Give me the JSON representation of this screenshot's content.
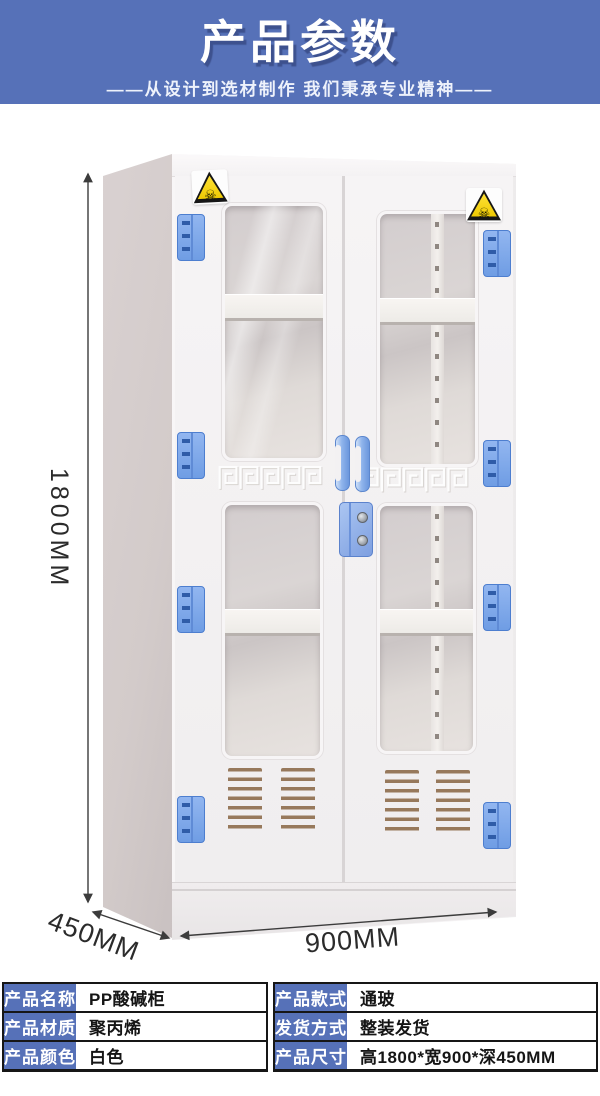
{
  "banner": {
    "title": "产品参数",
    "subtitle": "——从设计到选材制作 我们秉承专业精神——"
  },
  "figure": {
    "dimensions": {
      "height": "1800MM",
      "width": "900MM",
      "depth": "450MM"
    },
    "warning_symbol": "☠"
  },
  "colors": {
    "banner_bg": "#5671b8",
    "table_header_bg": "#5671b8",
    "hinge_blue": "#7fa8e8",
    "sticker_yellow": "#f2d200",
    "cabinet_white": "#f4f2f3"
  },
  "spec_table": {
    "left_rows": [
      {
        "label": "产品名称",
        "value": "PP酸碱柜"
      },
      {
        "label": "产品材质",
        "value": "聚丙烯"
      },
      {
        "label": "产品颜色",
        "value": "白色"
      }
    ],
    "right_rows": [
      {
        "label": "产品款式",
        "value": "通玻"
      },
      {
        "label": "发货方式",
        "value": "整装发货"
      },
      {
        "label": "产品尺寸",
        "value": "高1800*宽900*深450MM"
      }
    ]
  }
}
